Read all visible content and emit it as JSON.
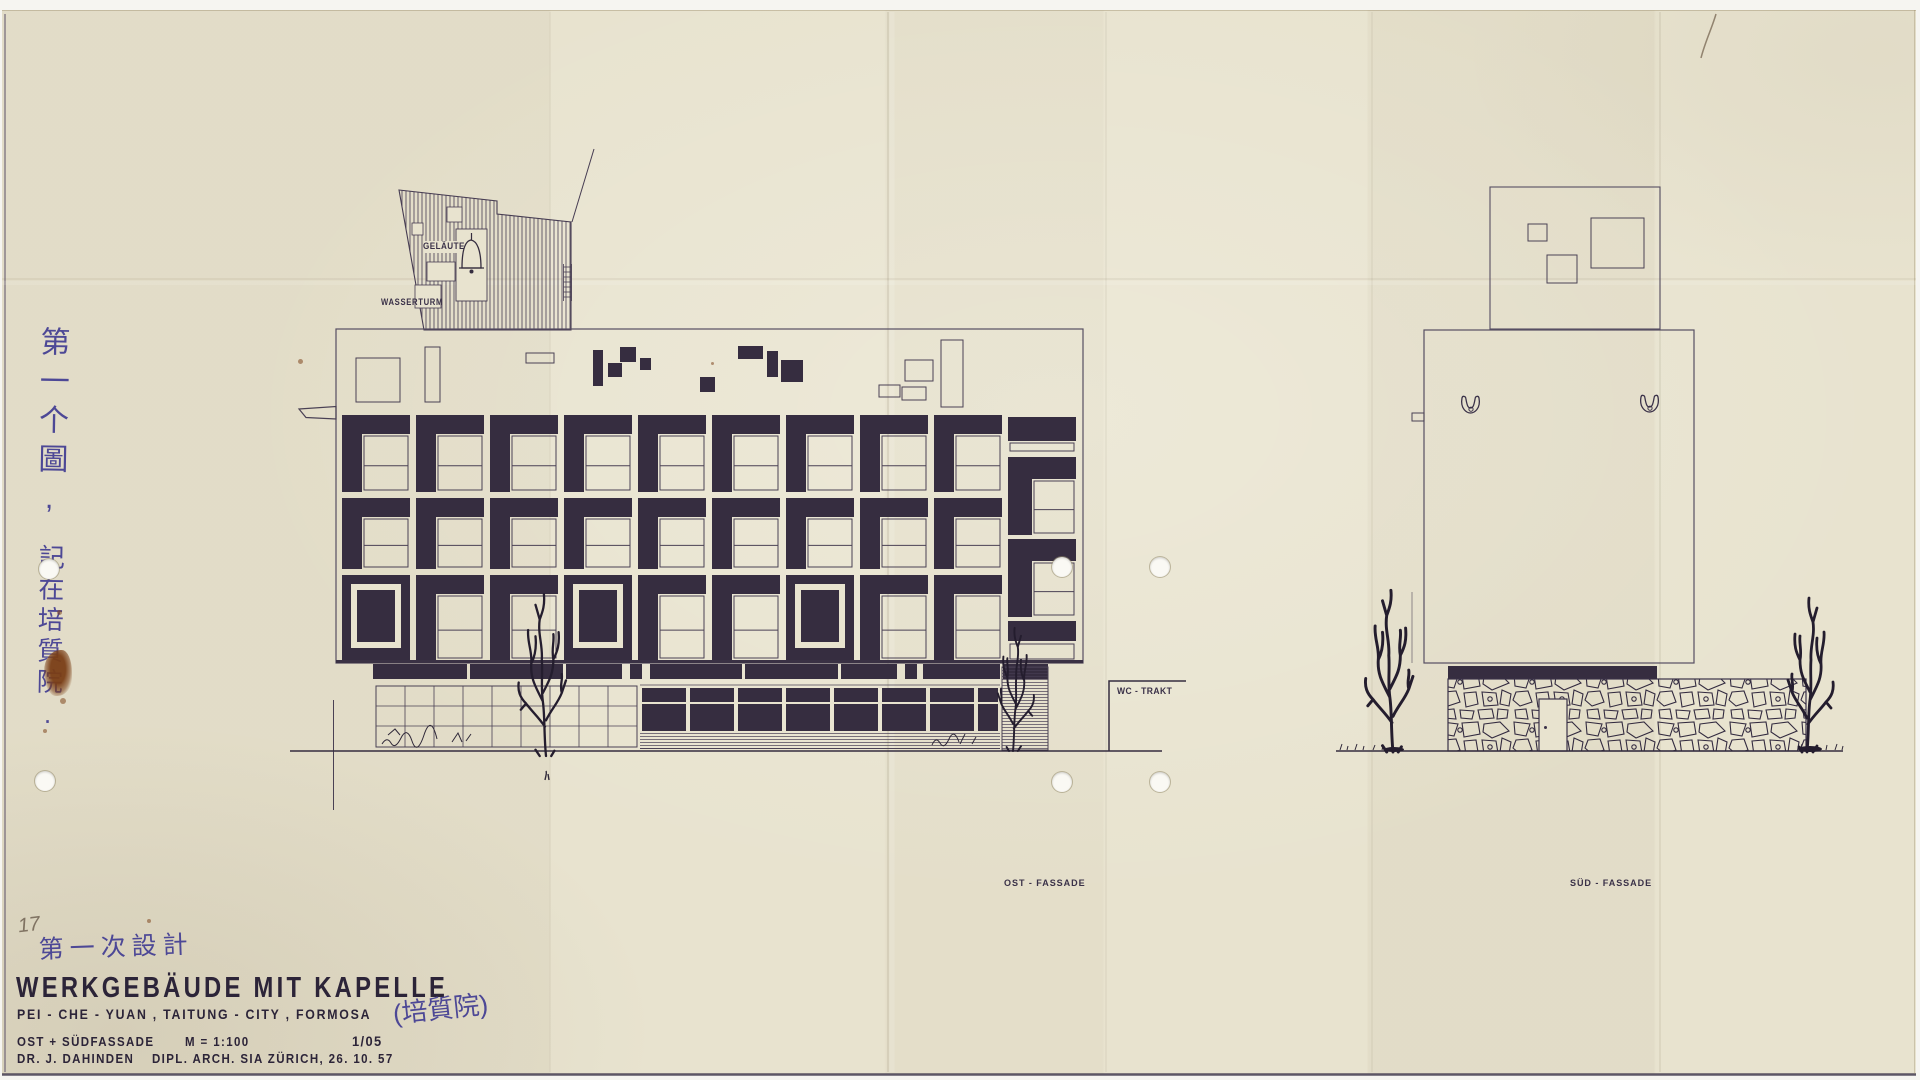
{
  "labels": {
    "gelaeute": "GELÄUTE",
    "wasserturm": "WASSERTURM",
    "wc_trakt": "WC - TRAKT",
    "ost_fassade": "OST - FASSADE",
    "sued_fassade": "SÜD - FASSADE"
  },
  "annotations": {
    "pencil_number": "17",
    "zh_vertical_1": "第一个圖,",
    "zh_vertical_2": "記在培質院.",
    "zh_design_note": "第一次設計",
    "zh_paren_note": "(培質院)"
  },
  "title_block": {
    "title": "WERKGEBÄUDE MIT KAPELLE",
    "subtitle": "PEI - CHE - YUAN , TAITUNG - CITY , FORMOSA",
    "facade_line": "OST + SÜDFASSADE",
    "scale": "M = 1:100",
    "sheet_no": "1/05",
    "author": "DR. J. DAHINDEN",
    "author_credentials": "DIPL. ARCH. SIA ZÜRICH, 26. 10. 57"
  },
  "colors": {
    "paper": "#e8e3cf",
    "ink_dark": "#362d40",
    "ink_line": "#4a4154",
    "blue_ink": "#4d4896",
    "stain": "#7a3e16"
  }
}
